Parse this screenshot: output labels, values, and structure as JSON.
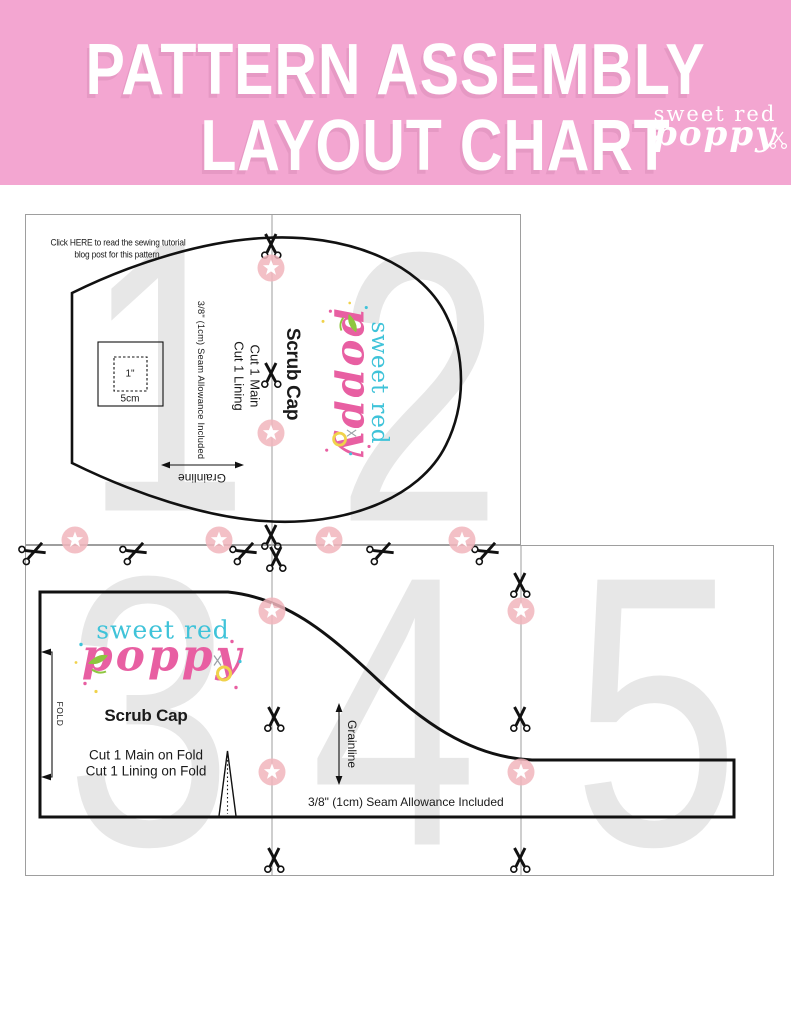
{
  "header": {
    "title_line1": "PATTERN ASSEMBLY",
    "title_line2": "LAYOUT CHART"
  },
  "brand": {
    "line1": "sweet red",
    "line2": "poppy"
  },
  "note": {
    "line1": "Click HERE to read the sewing tutorial",
    "line2": "blog post for this pattern."
  },
  "pages": {
    "numbers": [
      "1",
      "2",
      "3",
      "4",
      "5"
    ]
  },
  "top_piece": {
    "title": "Scrub Cap",
    "cut1": "Cut 1 Main",
    "cut2": "Cut 1 Lining",
    "seam_allowance": "3/8\" (1cm) Seam Allowance Included",
    "grainline": "Grainline",
    "test_square_outer": "5cm",
    "test_square_inner": "1\""
  },
  "bottom_piece": {
    "title": "Scrub Cap",
    "cut1": "Cut 1 Main on Fold",
    "cut2": "Cut 1 Lining on Fold",
    "seam_allowance": "3/8\" (1cm) Seam Allowance Included",
    "grainline": "Grainline",
    "fold": "FOLD"
  },
  "colors": {
    "header_bg": "#f3a6d1",
    "brand_teal": "#3fc3d9",
    "brand_pink": "#e85fa2",
    "page_number_gray": "#e7e7e7",
    "registration_pink": "#f1b5bc",
    "pattern_line": "#111111"
  }
}
